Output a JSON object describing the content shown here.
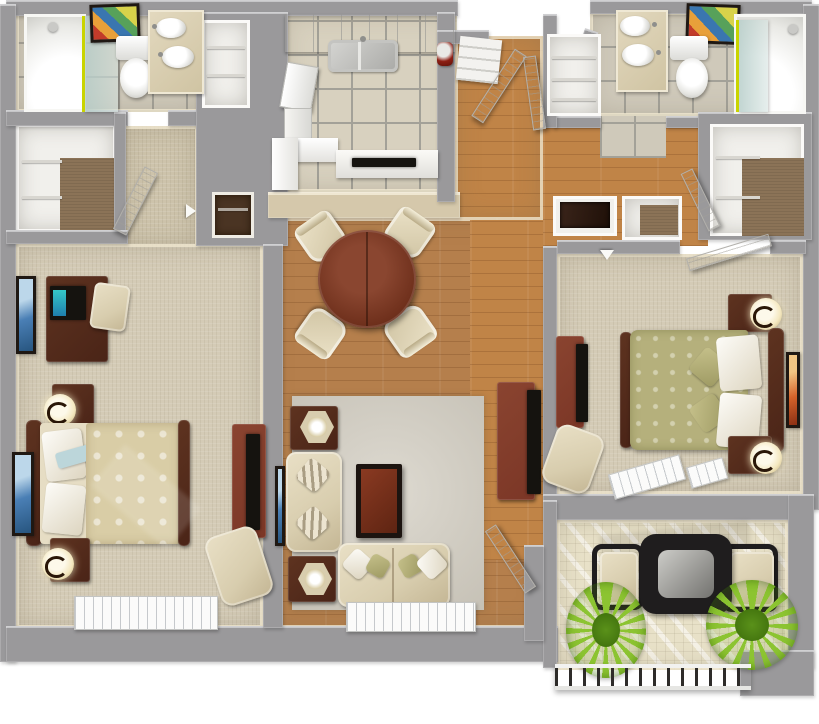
{
  "scene": {
    "description": "3D top-down rendered floor plan of a two-bedroom, two-bathroom apartment with kitchen, dining area, living room, walk-in closets, entry hall and patio",
    "view": "isometric top-down dollhouse render",
    "rooms": [
      {
        "id": "bathroom-1",
        "label": "Bathroom 1",
        "contents": [
          "walk-in shower with glass door",
          "toilet",
          "double-sink vanity",
          "framed wall art",
          "tile floor"
        ]
      },
      {
        "id": "walk-in-closet-1",
        "label": "Walk-in Closet 1",
        "contents": [
          "white shelving",
          "clothes rods",
          "brown carpet"
        ]
      },
      {
        "id": "bedroom-1",
        "label": "Bedroom 1",
        "contents": [
          "desk with monitor",
          "desk chair",
          "bed with cream patterned duvet",
          "two nightstands",
          "two lamps",
          "tv armoire",
          "armchair",
          "two framed artworks",
          "window"
        ]
      },
      {
        "id": "kitchen",
        "label": "Kitchen",
        "contents": [
          "upper cabinet run",
          "double stainless sink",
          "refrigerator",
          "lower cabinets",
          "bar counter with cooktop",
          "red countertop appliance",
          "tile floor"
        ]
      },
      {
        "id": "dining-area",
        "label": "Dining Area",
        "contents": [
          "round dark-wood table",
          "four cream chairs",
          "hardwood floor"
        ]
      },
      {
        "id": "living-room",
        "label": "Living Room",
        "contents": [
          "sofa",
          "loveseat",
          "coffee table",
          "two end tables with lamps",
          "tv console with flat tv",
          "area rug",
          "window",
          "framed art"
        ]
      },
      {
        "id": "entry-hall",
        "label": "Entry Hall",
        "contents": [
          "front door ajar",
          "second door panel",
          "pantry shelves",
          "hardwood floor"
        ]
      },
      {
        "id": "bathroom-2",
        "label": "Bathroom 2",
        "contents": [
          "double-sink vanity",
          "toilet",
          "framed wall art",
          "walk-in shower with glass door",
          "tile floor"
        ]
      },
      {
        "id": "laundry-closet",
        "label": "Laundry / Utility Closet",
        "contents": [
          "shelving"
        ]
      },
      {
        "id": "linen-closet",
        "label": "Linen Closet",
        "contents": [
          "shelving",
          "brown carpet"
        ]
      },
      {
        "id": "built-in-nook",
        "label": "Built-in Counter Nook",
        "contents": [
          "dark counter"
        ]
      },
      {
        "id": "walk-in-closet-2",
        "label": "Walk-in Closet 2",
        "contents": [
          "white shelving",
          "clothes rods",
          "brown carpet",
          "door ajar"
        ]
      },
      {
        "id": "bedroom-2",
        "label": "Bedroom 2",
        "contents": [
          "bed with olive patterned duvet",
          "two nightstands with lamps",
          "tv dresser",
          "armchair",
          "framed art",
          "two windows",
          "door ajar"
        ]
      },
      {
        "id": "patio",
        "label": "Patio",
        "contents": [
          "black metal bistro table with glass top",
          "two cushioned chairs",
          "two potted plants",
          "slatted railing",
          "sun-striped floor"
        ]
      }
    ],
    "colors": {
      "wall": "#9a999b",
      "wall-edge": "#c6c6c8",
      "carpet": "#d4cbb6",
      "carpet2": "#cdc3ab",
      "wood": "#b57f4c",
      "wood-hall": "#c08447",
      "tile": "#d8d1bf",
      "grout": "#a3a198",
      "rug": "#d2cdc1",
      "brown-carpet": "#8b7357",
      "darkwood": "#4a2417",
      "redwood": "#7b3626",
      "cream": "#d8cdae",
      "olive": "#b5b07c",
      "counter-tan": "#d5c8ab",
      "lamp-glow": "#f4e8c0",
      "shower-accent": "#c9d400",
      "plant": "#8fc23c",
      "black-metal": "#1f1d1e",
      "patio-floor": "#e8e1c8",
      "screen-teal": "#35c8c8",
      "throw-blue": "#bcd6da"
    }
  }
}
